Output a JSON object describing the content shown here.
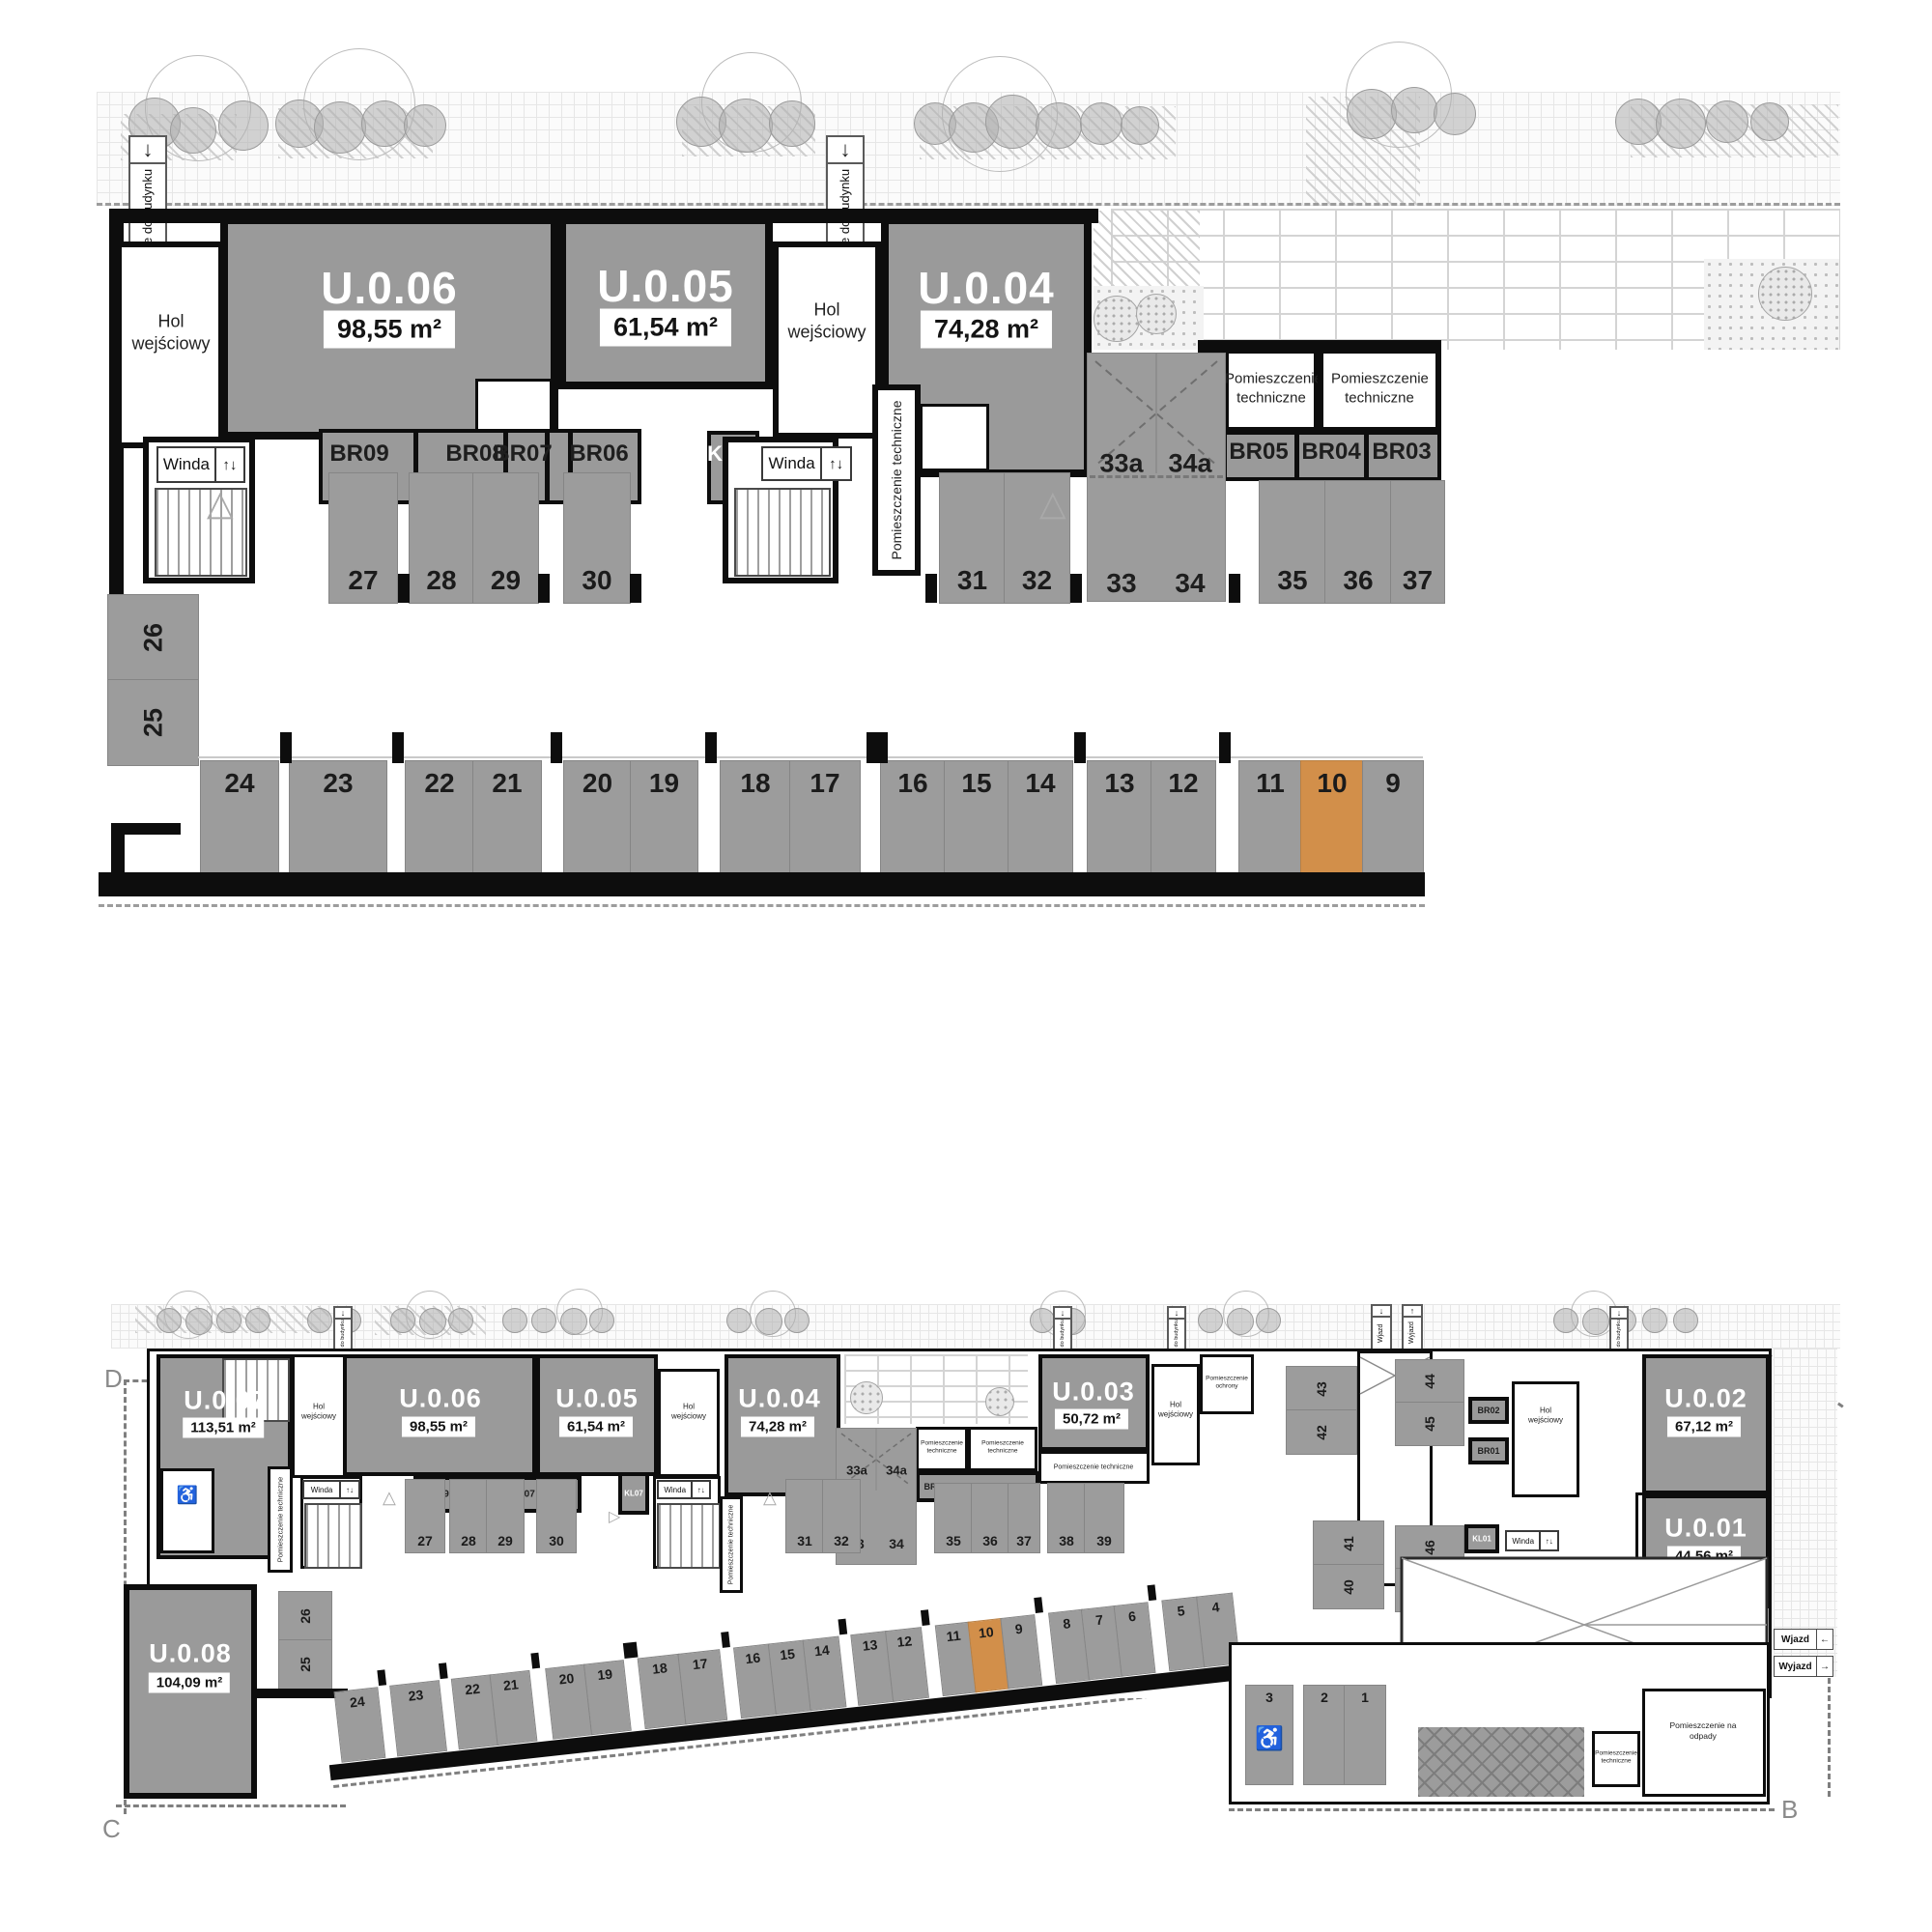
{
  "colors": {
    "highlight": "#D28F4A",
    "stall_gray": "#9C9C9C",
    "unit_gray": "#9A9A9A",
    "wall_black": "#0D0D0D"
  },
  "detail_plan": {
    "entrance_sign": "Wejście do budynku",
    "entrance_arrow": "↓",
    "units": [
      {
        "id": "U.0.06",
        "area": "98,55 m²"
      },
      {
        "id": "U.0.05",
        "area": "61,54 m²"
      },
      {
        "id": "U.0.04",
        "area": "74,28 m²"
      }
    ],
    "hall_label": "Hol wejściowy",
    "elevator_label": "Winda",
    "elevator_arrows": "↑↓",
    "stairwell": "KL07",
    "storage_rooms": [
      "BR09",
      "BR08",
      "BR07",
      "BR06"
    ],
    "storage_rooms_right": [
      "BR05",
      "BR04",
      "BR03"
    ],
    "tech_room": "Pomieszczenie techniczne",
    "tandem_spaces": [
      "33a",
      "34a"
    ],
    "top_row_spaces": [
      "27",
      "28",
      "29",
      "30",
      "31",
      "32",
      "33",
      "34",
      "35",
      "36",
      "37"
    ],
    "side_spaces": [
      "26",
      "25"
    ],
    "bottom_row_spaces": [
      "24",
      "23",
      "22",
      "21",
      "20",
      "19",
      "18",
      "17",
      "16",
      "15",
      "14",
      "13",
      "12",
      "11",
      "10",
      "9"
    ],
    "highlighted_space": "10"
  },
  "overview_plan": {
    "corners": {
      "top_left": "D",
      "top_right": "A",
      "bottom_left": "C",
      "bottom_right": "B"
    },
    "units": [
      {
        "id": "U.0.07",
        "area": "113,51 m²"
      },
      {
        "id": "U.0.06",
        "area": "98,55 m²"
      },
      {
        "id": "U.0.05",
        "area": "61,54 m²"
      },
      {
        "id": "U.0.04",
        "area": "74,28 m²"
      },
      {
        "id": "U.0.03",
        "area": "50,72 m²"
      },
      {
        "id": "U.0.02",
        "area": "67,12 m²"
      },
      {
        "id": "U.0.01",
        "area": "44,56 m²"
      },
      {
        "id": "U.0.08",
        "area": "104,09 m²"
      }
    ],
    "hall_label": "Hol wejściowy",
    "elevator_label": "Winda",
    "elevator_arrows": "↑↓",
    "entrance_sign": "Wejście do budynku",
    "entrance_arrow": "↓",
    "security_room": "Pomieszczenie ochrony",
    "waste_room": "Pomieszczenie na odpady",
    "tech_room": "Pomieszczenie techniczne",
    "stairwells": [
      "KL07",
      "KL01"
    ],
    "storage_left": [
      "BR09",
      "BR08",
      "BR07",
      "BR06"
    ],
    "storage_mid": [
      "BR05",
      "BR04",
      "BR03"
    ],
    "storage_right": [
      "BR02",
      "BR01"
    ],
    "gates_top": [
      {
        "label": "Wjazd",
        "arrow": "↓"
      },
      {
        "label": "Wyjazd",
        "arrow": "↑"
      }
    ],
    "gates_right": [
      {
        "label": "Wjazd",
        "arrow": "←"
      },
      {
        "label": "Wyjazd",
        "arrow": "→"
      }
    ],
    "tandem_spaces": [
      "33a",
      "34a"
    ],
    "top_row_spaces": [
      "27",
      "28",
      "29",
      "30",
      "31",
      "32",
      "33",
      "34",
      "35",
      "36",
      "37",
      "38",
      "39"
    ],
    "side_spaces": [
      "26",
      "25"
    ],
    "right_wing_spaces": [
      "43",
      "42",
      "44",
      "45",
      "41",
      "40",
      "46",
      "47",
      "48"
    ],
    "bottom_row_spaces": [
      "24",
      "23",
      "22",
      "21",
      "20",
      "19",
      "18",
      "17",
      "16",
      "15",
      "14",
      "13",
      "12",
      "11",
      "10",
      "9",
      "8",
      "7",
      "6",
      "5",
      "4"
    ],
    "right_section_spaces": [
      "3",
      "2",
      "1"
    ],
    "highlighted_space": "10",
    "accessible_icon": "♿"
  }
}
